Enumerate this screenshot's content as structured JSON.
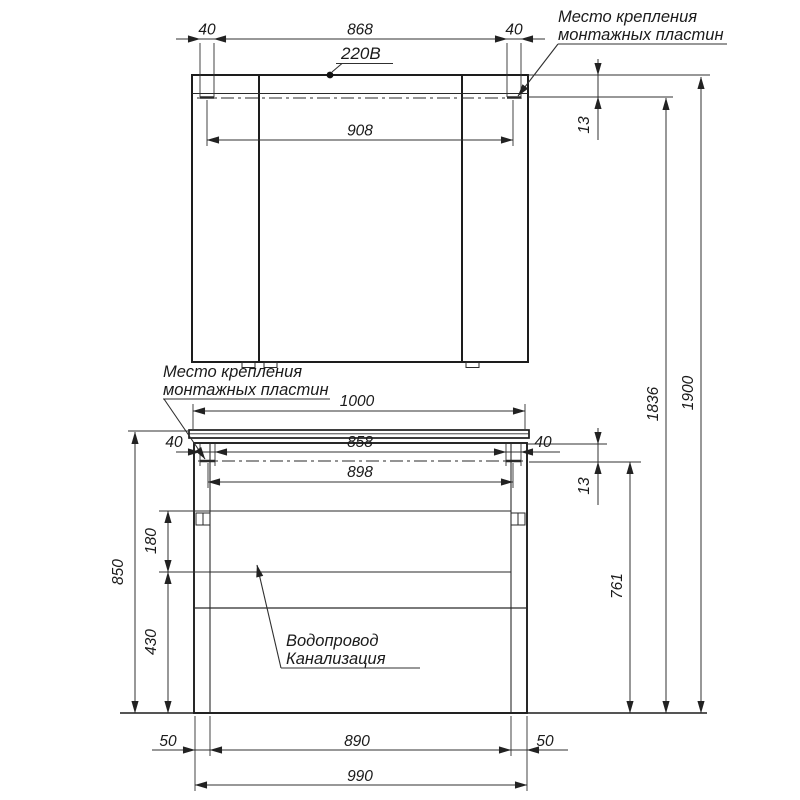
{
  "drawing": {
    "labels": {
      "power": "220В",
      "mount_top": {
        "line1": "Место крепления",
        "line2": "монтажных пластин"
      },
      "mount_mid": {
        "line1": "Место крепления",
        "line2": "монтажных пластин"
      },
      "utilities": {
        "line1": "Водопровод",
        "line2": "Канализация"
      }
    },
    "dims": {
      "top_offset_left": "40",
      "top_span": "868",
      "top_offset_right": "40",
      "mirror_plate_span": "908",
      "mirror_plate_inset": "13",
      "mirror_plate_height": "1836",
      "total_height": "1900",
      "countertop_width": "1000",
      "mid_offset_left": "40",
      "mid_span": "858",
      "mid_offset_right": "40",
      "vanity_plate_span": "898",
      "vanity_plate_inset": "13",
      "vanity_height": "850",
      "utility_zone_height": "180",
      "clearance_height": "430",
      "vanity_plate_height": "761",
      "base_offset_left": "50",
      "base_span": "890",
      "base_offset_right": "50",
      "base_width": "990"
    }
  }
}
